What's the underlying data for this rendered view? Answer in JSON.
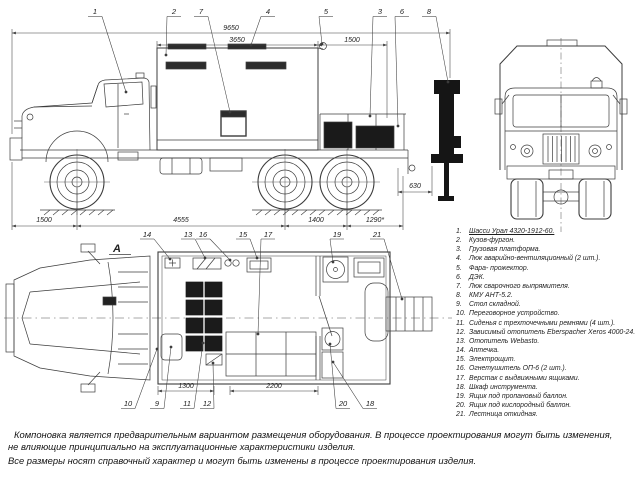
{
  "drawing": {
    "view_label": "А",
    "dimensions": {
      "side_top": [
        "9650",
        "3650",
        "1500"
      ],
      "side_bottom": [
        "1500",
        "4555",
        "1400",
        "1290*"
      ],
      "side_rear": "630",
      "plan": [
        "1300",
        "2200"
      ]
    },
    "callouts": {
      "side": [
        "1",
        "2",
        "7",
        "4",
        "5",
        "3",
        "6",
        "8"
      ],
      "plan_top": [
        "14",
        "13",
        "16",
        "15",
        "17",
        "19",
        "21"
      ],
      "plan_bottom": [
        "10",
        "9",
        "11",
        "12",
        "20",
        "18"
      ]
    }
  },
  "parts_list": [
    {
      "num": "1.",
      "label": "Шасси Урал 4320-1912-60."
    },
    {
      "num": "2.",
      "label": "Кузов-фургон."
    },
    {
      "num": "3.",
      "label": "Грузовая платформа."
    },
    {
      "num": "4.",
      "label": "Люк аварийно-вентиляционный (2 шт.)."
    },
    {
      "num": "5.",
      "label": "Фара- прожектор."
    },
    {
      "num": "6.",
      "label": "ДЭК."
    },
    {
      "num": "7.",
      "label": "Люк сварочного выпрямителя."
    },
    {
      "num": "8.",
      "label": "КМУ АНТ-5.2."
    },
    {
      "num": "9.",
      "label": "Стол складной."
    },
    {
      "num": "10.",
      "label": "Переговорное устройство."
    },
    {
      "num": "11.",
      "label": "Сиденья с трехточечными ремнями (4 шт.)."
    },
    {
      "num": "12.",
      "label": "Зависимый отопитель Eberspacher Xeros 4000-24."
    },
    {
      "num": "13.",
      "label": "Отопитель Webasto."
    },
    {
      "num": "14.",
      "label": "Аптечка."
    },
    {
      "num": "15.",
      "label": "Электрощит."
    },
    {
      "num": "16.",
      "label": "Огнетушитель ОП-6 (2 шт.)."
    },
    {
      "num": "17.",
      "label": "Верстак с выдвижными ящиками."
    },
    {
      "num": "18.",
      "label": "Шкаф инструмента."
    },
    {
      "num": "19.",
      "label": "Ящик под пропановый баллон."
    },
    {
      "num": "20.",
      "label": "Ящик под кислородный баллон."
    },
    {
      "num": "21.",
      "label": "Лестница откидная."
    }
  ],
  "notes": [
    "Компоновка является предварительным вариантом размещения оборудования.  В процессе проектирования могут быть изменения,",
    "не влияющие принципиально на эксплуатационные характеристики изделия.",
    "Все размеры носят справочный характер и могут быть изменены в процессе проектирования изделия."
  ]
}
